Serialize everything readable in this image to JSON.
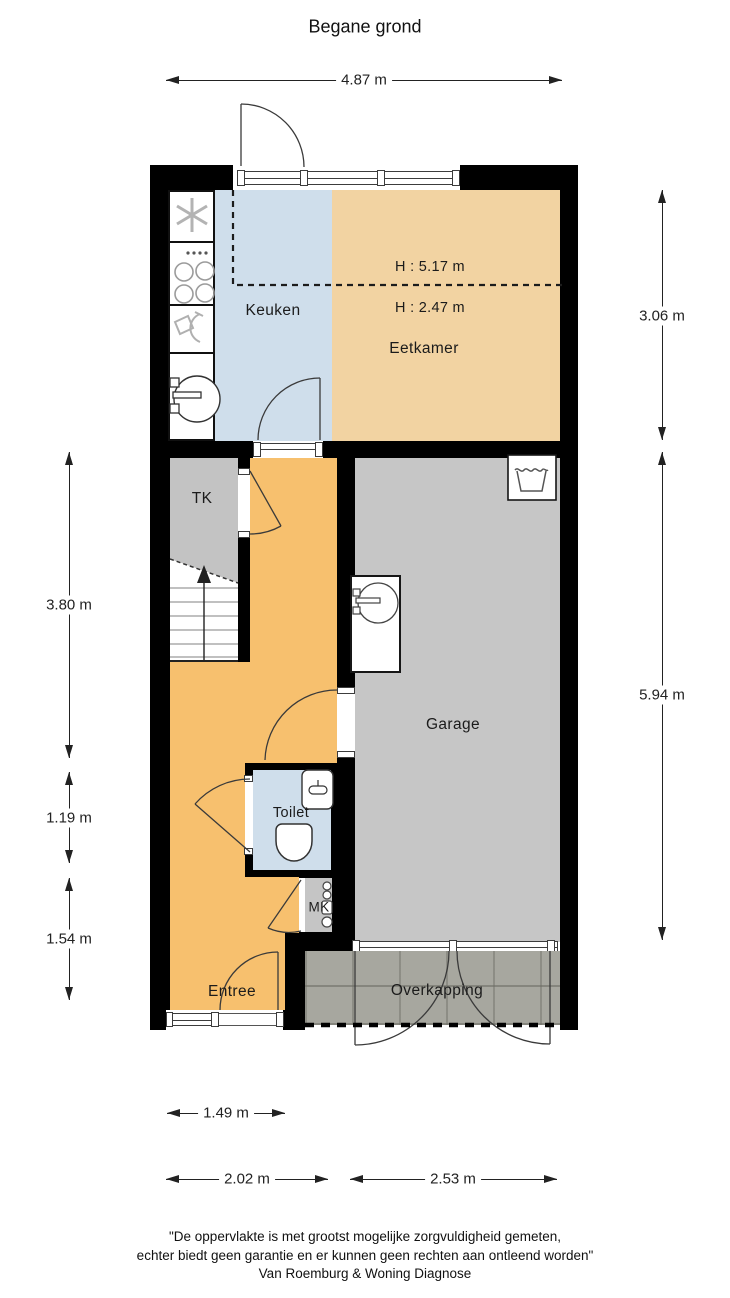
{
  "title": "Begane grond",
  "rooms": {
    "keuken": {
      "label": "Keuken"
    },
    "eetkamer": {
      "label": "Eetkamer",
      "h_upper": "H : 5.17 m",
      "h_lower": "H : 2.47 m"
    },
    "tk": {
      "label": "TK"
    },
    "garage": {
      "label": "Garage"
    },
    "toilet": {
      "label": "Toilet"
    },
    "mk": {
      "label": "MK"
    },
    "entree": {
      "label": "Entree"
    },
    "overkapping": {
      "label": "Overkapping"
    }
  },
  "dims": {
    "top": "4.87 m",
    "right_upper": "3.06 m",
    "right_lower": "5.94 m",
    "left_upper": "3.80 m",
    "left_mid": "1.19 m",
    "left_lower": "1.54 m",
    "bottom_small": "1.49 m",
    "bottom_left": "2.02 m",
    "bottom_right": "2.53 m"
  },
  "footer": {
    "line1": "\"De oppervlakte is met grootst mogelijke zorgvuldigheid gemeten,",
    "line2": "echter biedt geen garantie en er kunnen geen rechten aan ontleend worden\"",
    "line3": "Van Roemburg & Woning Diagnose"
  },
  "colors": {
    "wall": "#000000",
    "keuken": "#cfdeeb",
    "eetkamer": "#f2d3a2",
    "hal_entree": "#f7c06e",
    "garage": "#c6c6c6",
    "tk": "#c3c3c3",
    "toilet": "#cfdeeb",
    "mk": "#c5c5c5",
    "overkapping_paving": "#a7a79f"
  },
  "icons": {
    "kitchen": [
      "extractor-fan-icon",
      "stove-icon",
      "dishwasher-icon",
      "kitchen-sink-icon"
    ],
    "garage": [
      "washing-machine-icon",
      "garage-sink-icon"
    ],
    "toilet": [
      "hand-sink-icon",
      "toilet-bowl-icon"
    ],
    "stairs": [
      "stairs-up-arrow-icon"
    ]
  }
}
